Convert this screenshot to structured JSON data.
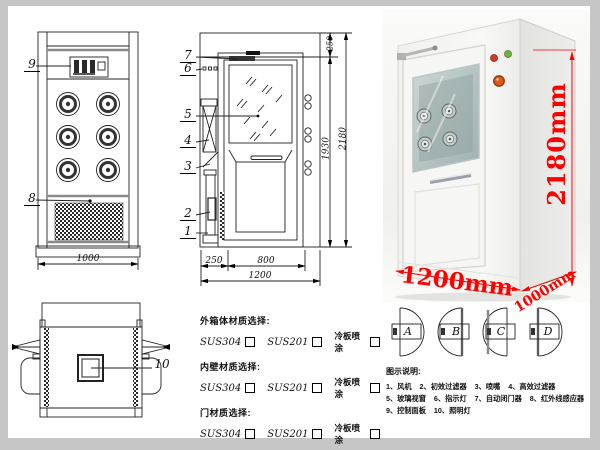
{
  "sheet": {
    "type": "air-shower-technical-sheet",
    "frame_color": "#c6c6c6"
  },
  "front_view": {
    "callout_top": "9",
    "callout_bottom": "8",
    "dim_width": "1000"
  },
  "section_view": {
    "callouts": [
      "7",
      "6",
      "5",
      "4",
      "3",
      "2",
      "1"
    ],
    "dim_left": "250",
    "dim_door": "800",
    "dim_total": "1200",
    "dim_inner_height": "1930",
    "dim_total_height": "2180",
    "dim_top": "250"
  },
  "photo": {
    "dim_height": "2180mm",
    "dim_width": "1200mm",
    "dim_depth": "1000mm",
    "dimension_red": "#ff0000",
    "indicator_light_red": "#cf3a22",
    "indicator_light_green": "#76b043",
    "emergency_button_orange": "#e05a1e"
  },
  "top_view": {
    "callout": "10"
  },
  "materials": {
    "groups": [
      {
        "title": "外箱体材质选择:",
        "options": [
          "SUS304",
          "SUS201",
          "冷板喷涂"
        ]
      },
      {
        "title": "内壁材质选择:",
        "options": [
          "SUS304",
          "SUS201",
          "冷板喷涂"
        ]
      },
      {
        "title": "门材质选择:",
        "options": [
          "SUS304",
          "SUS201",
          "冷板喷涂"
        ]
      }
    ]
  },
  "door_configs": {
    "labels": [
      "A",
      "B",
      "C",
      "D"
    ]
  },
  "legend": {
    "title": "图示说明:",
    "lines": [
      "1、风机    2、初效过滤器    3、喷嘴    4、高效过滤器",
      "5、玻璃视窗    6、指示灯    7、自动闭门器    8、红外线感应器",
      "9、控制面板    10、照明灯"
    ]
  }
}
